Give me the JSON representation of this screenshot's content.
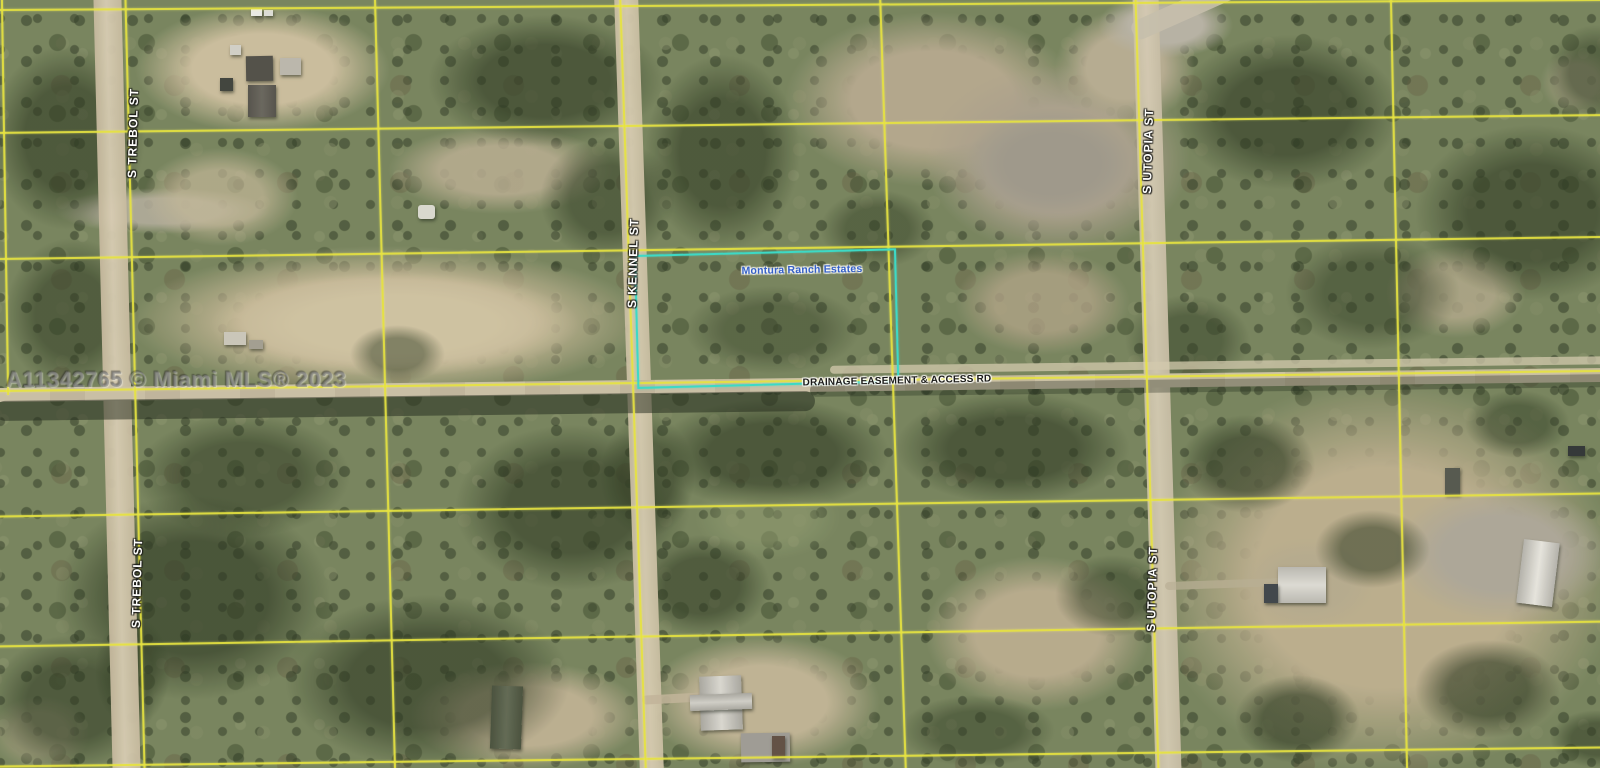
{
  "map": {
    "type": "satellite-parcel-map",
    "labels": {
      "watermark": "A11342765 © Miami MLS® 2023",
      "street_trebol_upper": "S TREBOL ST",
      "street_trebol_lower": "S TREBOL ST",
      "street_kennel": "S KENNEL ST",
      "street_utopia_upper": "S UTOPIA ST",
      "street_utopia_lower": "S UTOPIA ST",
      "road_drainage": "DRAINAGE EASEMENT & ACCESS RD",
      "parcel_highlight": "Montura Ranch Estates"
    },
    "colors": {
      "parcel_grid_line": "#e7e33a",
      "highlight_parcel_outline": "#34d9c6",
      "street_label_text": "#ffffff",
      "parcel_label_text": "#2a58c8",
      "road_label_text": "#101010",
      "watermark_text": "#808080"
    }
  }
}
